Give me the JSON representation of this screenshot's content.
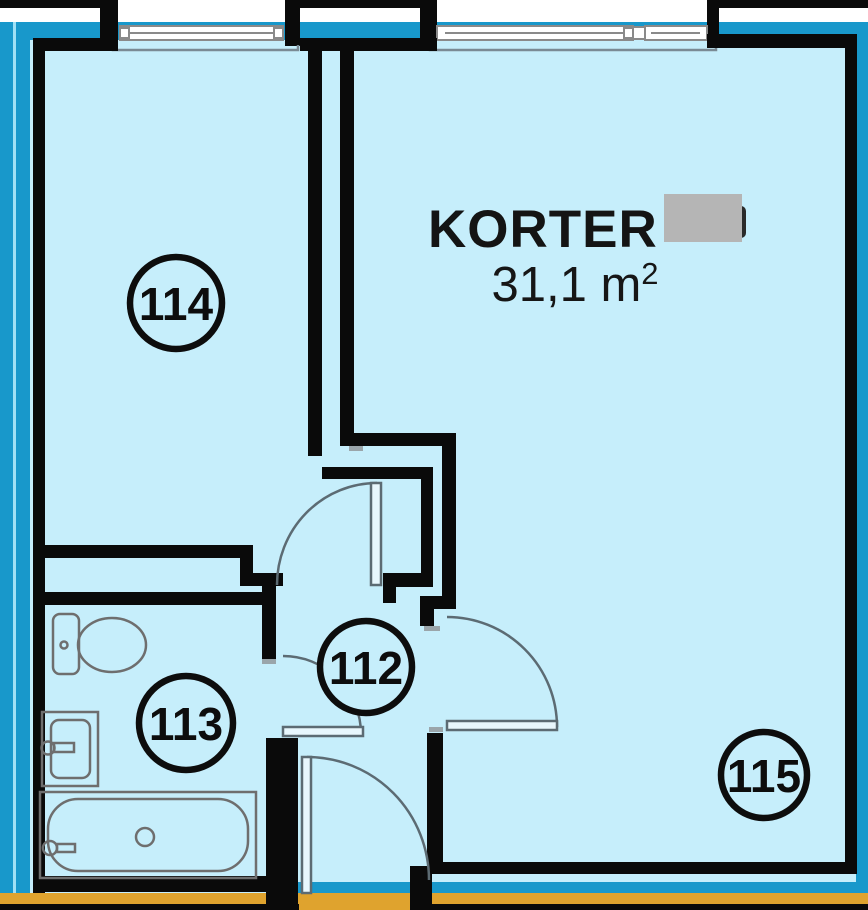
{
  "title": {
    "name": "KORTER",
    "area": "31,1 m",
    "area_superscript": "2",
    "number_redacted": true
  },
  "rooms": [
    {
      "number": "114",
      "type": "room"
    },
    {
      "number": "112",
      "type": "hallway"
    },
    {
      "number": "113",
      "type": "bathroom"
    },
    {
      "number": "115",
      "type": "main-room"
    }
  ],
  "fixtures": [
    "toilet",
    "sink",
    "bathtub"
  ],
  "features": [
    "windows-top",
    "door-swings",
    "entrance-door-bottom"
  ],
  "colors": {
    "interior": "#c6eefb",
    "band_cyan": "#1898cb",
    "band_gap": "#9fe0f5",
    "strip_yellow": "#dfa32e",
    "wall_black": "#0a0a0a",
    "fixture_gray": "#6e6e6e",
    "door_gray": "#5c6b73",
    "window_gray": "#8a8a8a",
    "redact_gray": "#b5b5b5",
    "exterior_white": "#ffffff"
  }
}
